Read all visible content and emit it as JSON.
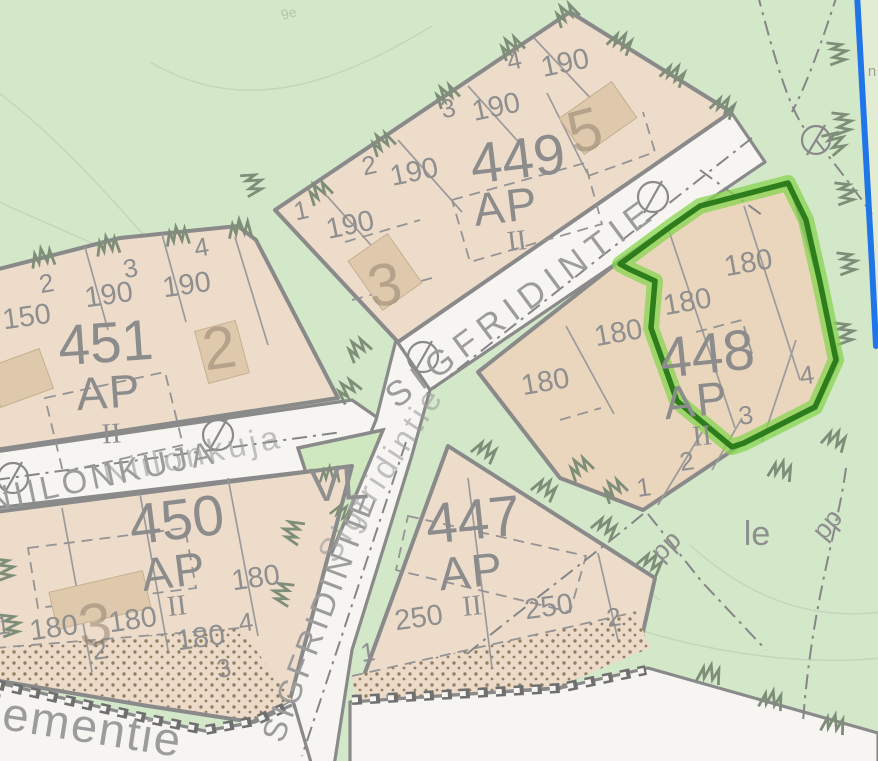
{
  "blocks": {
    "449": {
      "number": "449",
      "zoning": "AP",
      "floors": "II",
      "lots": [
        "1",
        "2",
        "3",
        "4"
      ],
      "areas": [
        "190",
        "190",
        "190",
        "190"
      ],
      "address_numbers": [
        "3",
        "5"
      ]
    },
    "451": {
      "number": "451",
      "zoning": "AP",
      "floors": "II",
      "lots": [
        "2",
        "3",
        "4"
      ],
      "areas": [
        "150",
        "190",
        "190"
      ],
      "address_numbers": [
        "2"
      ]
    },
    "450": {
      "number": "450",
      "zoning": "AP",
      "floors": "II",
      "lots": [
        "1",
        "2",
        "3",
        "4"
      ],
      "areas": [
        "180",
        "180",
        "180",
        "180"
      ],
      "address_numbers": [
        "3"
      ]
    },
    "447": {
      "number": "447",
      "zoning": "AP",
      "floors": "II",
      "lots": [
        "1",
        "2"
      ],
      "areas": [
        "250",
        "250"
      ]
    },
    "448": {
      "number": "448",
      "zoning": "AP",
      "floors": "II",
      "highlighted": true,
      "lots": [
        "1",
        "2",
        "3",
        "4"
      ],
      "areas": [
        "180",
        "180",
        "180",
        "180"
      ]
    }
  },
  "streets": {
    "sigfridintie_upper": "SIGFRIDINTIE",
    "sigfridintie_lower": "SIGFRIDINTIE",
    "sigfridintie_script": "Sigfridintie",
    "niilonkuja_upper": "NIILONKUJA",
    "niilonkuja_script": "Niilonkuja",
    "niemientie_partial": "iementie"
  },
  "zone_labels": {
    "vl": "VL",
    "le": "le",
    "pp_west": "pp",
    "pp_east": "pp"
  },
  "fragments": {
    "contour_label": "9e",
    "right_edge_text": "n"
  },
  "colors": {
    "selection_green": "#2e7d1c",
    "selection_glow": "#85d44f",
    "boundary_blue": "#2076e8",
    "parcel_tan": "#eddcca",
    "green_area": "#d3e7c9",
    "road_white": "#f6f5f2",
    "map_gray": "#8a8a8a"
  }
}
